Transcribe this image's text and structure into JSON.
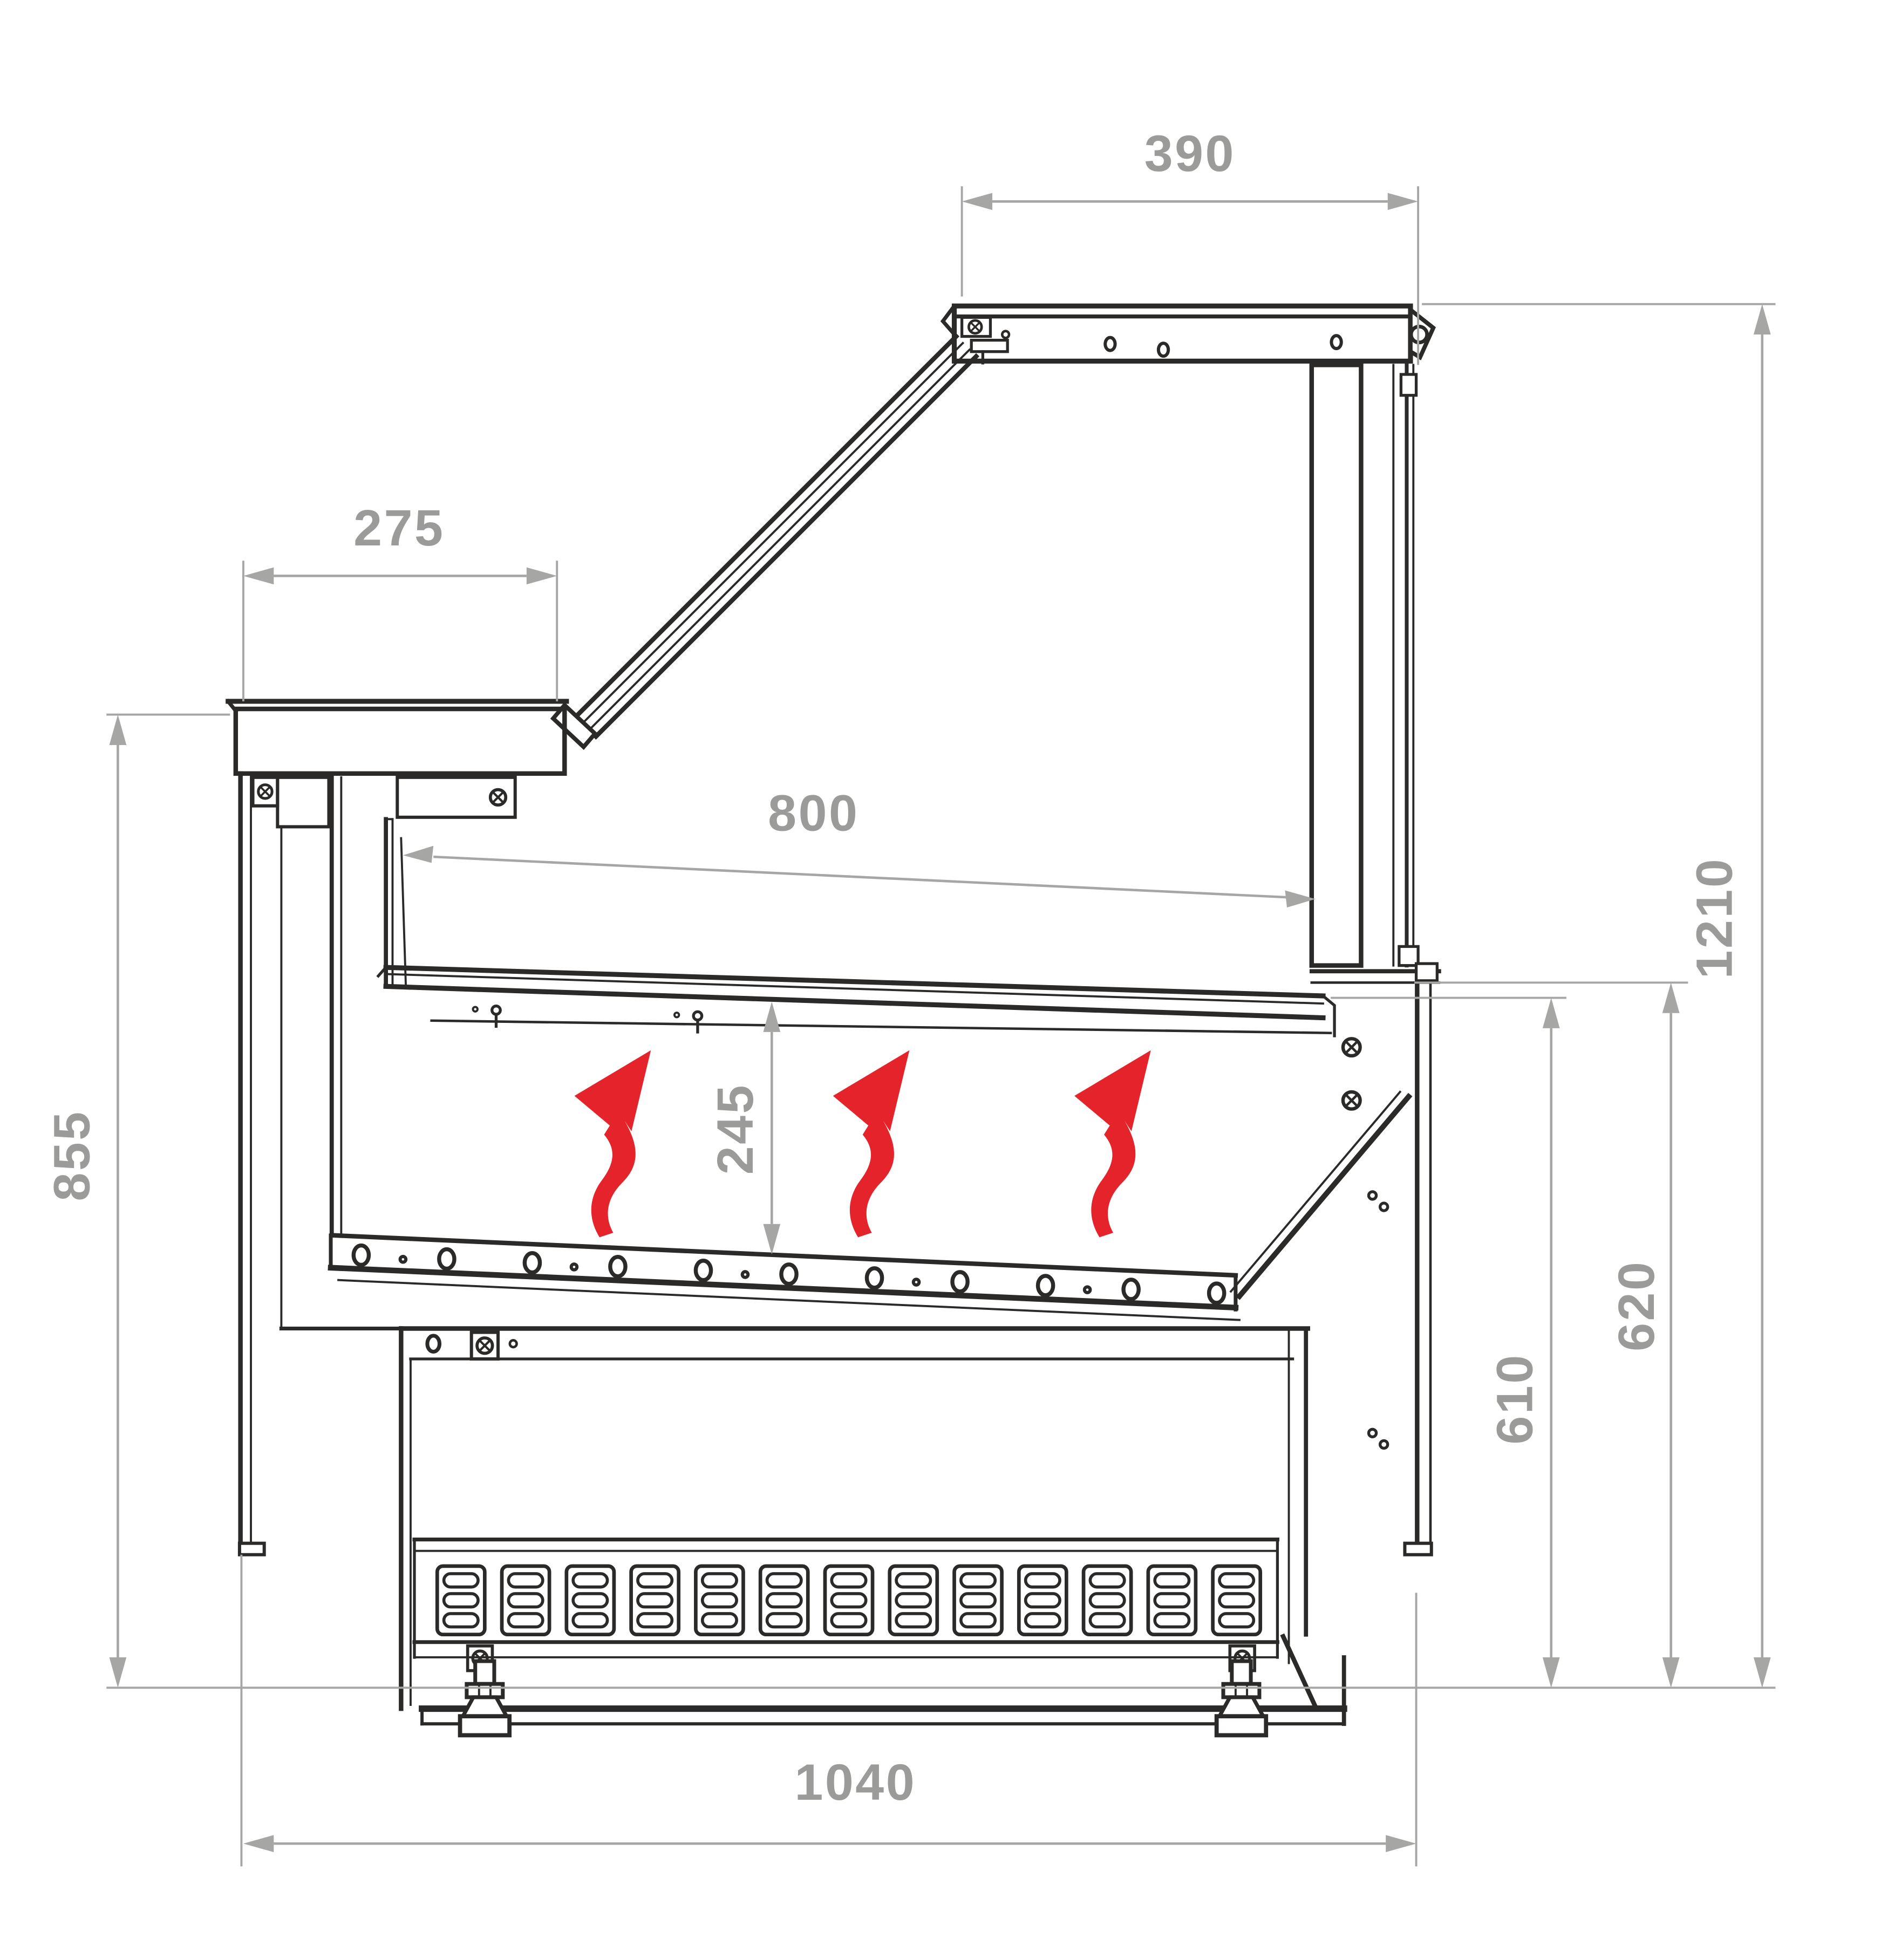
{
  "drawing": {
    "type": "technical-cross-section",
    "subject": "serve-over display counter side section with overall dimensions and airflow arrows",
    "units": "mm",
    "colors": {
      "line": "#2b2a29",
      "dimension_line": "#a6a6a5",
      "dimension_text": "#9b9b9a",
      "airflow_arrow": "#e5232a",
      "background": "#ffffff"
    },
    "dimensions": {
      "top_width": {
        "label": "390",
        "orientation": "horizontal"
      },
      "counter_top_depth": {
        "label": "275",
        "orientation": "horizontal"
      },
      "deck_depth": {
        "label": "800",
        "orientation": "horizontal"
      },
      "overall_height": {
        "label": "1210",
        "orientation": "vertical"
      },
      "worktop_height": {
        "label": "855",
        "orientation": "vertical"
      },
      "front_duct_height": {
        "label": "245",
        "orientation": "vertical"
      },
      "rear_inner_height": {
        "label": "610",
        "orientation": "vertical"
      },
      "rear_ledge_height": {
        "label": "620",
        "orientation": "vertical"
      },
      "overall_depth": {
        "label": "1040",
        "orientation": "horizontal"
      }
    },
    "annotations": {
      "airflow_arrows_count": 3
    }
  }
}
